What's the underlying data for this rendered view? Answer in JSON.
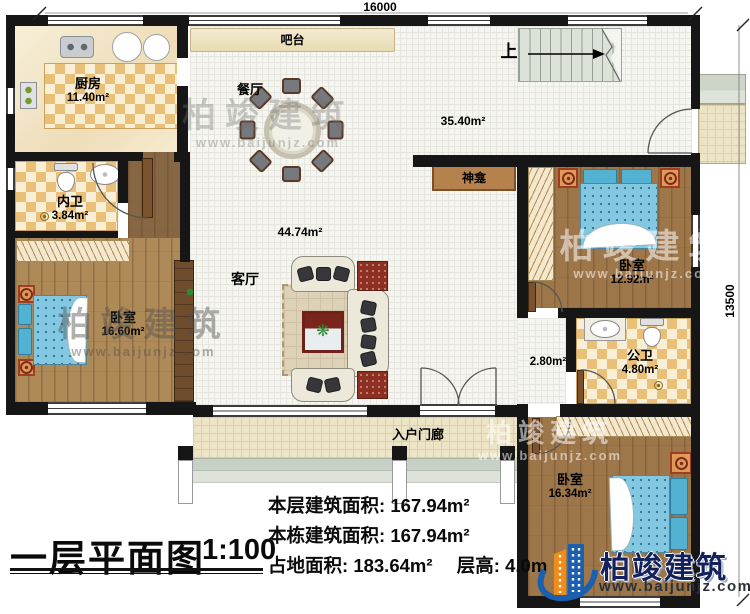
{
  "title_block": {
    "title": "一层平面图",
    "scale": "1:100"
  },
  "stats": {
    "floor_area_label": "本层建筑面积:",
    "floor_area_value": "167.94m²",
    "total_area_label": "本栋建筑面积:",
    "total_area_value": "167.94m²",
    "land_area_label": "占地面积:",
    "land_area_value": "183.64m²",
    "height_label": "层高:",
    "height_value": "4.0m"
  },
  "dimensions": {
    "width_mm": "16000",
    "height_mm": "13500"
  },
  "rooms": {
    "kitchen": {
      "name": "厨房",
      "area": "11.40m²"
    },
    "bar_counter": {
      "name": "吧台"
    },
    "dining_room": {
      "name": "餐厅"
    },
    "upper_hall": {
      "area": "35.40m²"
    },
    "stairs": {
      "direction": "上"
    },
    "shrine": {
      "name": "神龛"
    },
    "inner_bathroom": {
      "name": "内卫",
      "area": "3.84m²"
    },
    "bedroom_left": {
      "name": "卧室",
      "area": "16.60m²"
    },
    "living_room": {
      "name": "客厅",
      "area": "44.74m²"
    },
    "bedroom_right": {
      "name": "卧室",
      "area": "12.92m²"
    },
    "public_bathroom": {
      "name": "公卫",
      "area": "4.80m²"
    },
    "hallway": {
      "area": "2.80m²"
    },
    "bedroom_bottom": {
      "name": "卧室",
      "area": "16.34m²"
    },
    "entry_porch": {
      "name": "入户门廊"
    }
  },
  "brand": {
    "name": "柏竣建筑",
    "website": "www.baijunjz.com"
  }
}
